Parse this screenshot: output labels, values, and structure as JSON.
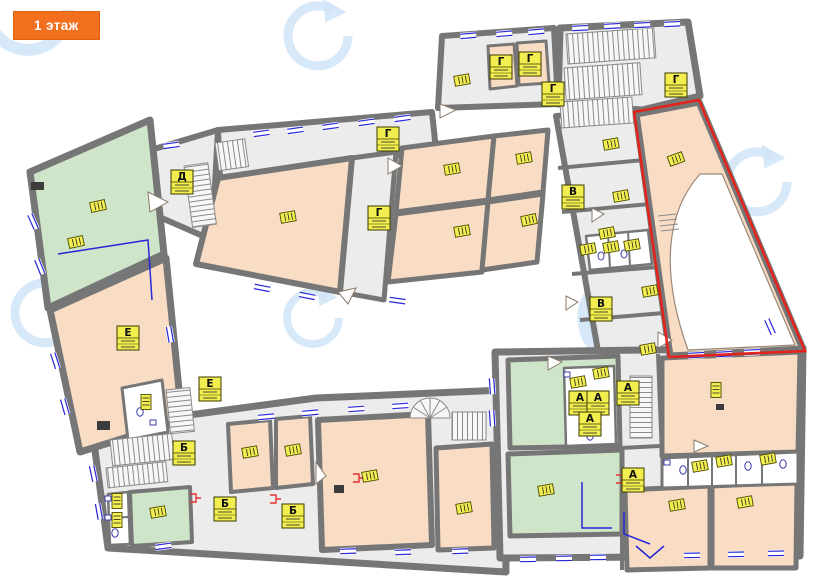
{
  "badge": {
    "label": "1 этаж"
  },
  "highlight": {
    "points": "634,112 699,100 805,351 669,357",
    "color": "#e3231c"
  },
  "colors": {
    "wall": "#767676",
    "floor_gray": "#ececec",
    "room_peach": "#f8dcc4",
    "room_green": "#cfe5c9",
    "label_bg": "#f2ee4f",
    "window_blue": "#2626d8",
    "watermark": "#d3e6f8",
    "highlight_red": "#e3231c"
  },
  "room_labels": [
    {
      "letter": "Г",
      "x": 501,
      "y": 67
    },
    {
      "letter": "Г",
      "x": 530,
      "y": 64
    },
    {
      "letter": "Г",
      "x": 553,
      "y": 94
    },
    {
      "letter": "Г",
      "x": 676,
      "y": 85
    },
    {
      "letter": "Г",
      "x": 388,
      "y": 139
    },
    {
      "letter": "Г",
      "x": 379,
      "y": 218
    },
    {
      "letter": "Д",
      "x": 182,
      "y": 182
    },
    {
      "letter": "В",
      "x": 573,
      "y": 197
    },
    {
      "letter": "В",
      "x": 601,
      "y": 309
    },
    {
      "letter": "Е",
      "x": 128,
      "y": 338
    },
    {
      "letter": "Е",
      "x": 210,
      "y": 389
    },
    {
      "letter": "Б",
      "x": 184,
      "y": 453
    },
    {
      "letter": "Б",
      "x": 225,
      "y": 509
    },
    {
      "letter": "Б",
      "x": 293,
      "y": 516
    },
    {
      "letter": "А",
      "x": 580,
      "y": 403
    },
    {
      "letter": "А",
      "x": 598,
      "y": 403
    },
    {
      "letter": "А",
      "x": 590,
      "y": 424
    },
    {
      "letter": "А",
      "x": 628,
      "y": 393
    },
    {
      "letter": "А",
      "x": 633,
      "y": 480
    }
  ],
  "mini_labels": [
    {
      "x": 98,
      "y": 206,
      "r": 78
    },
    {
      "x": 76,
      "y": 242,
      "r": 78
    },
    {
      "x": 288,
      "y": 217,
      "r": 80
    },
    {
      "x": 452,
      "y": 169,
      "r": 80
    },
    {
      "x": 524,
      "y": 158,
      "r": 80
    },
    {
      "x": 462,
      "y": 231,
      "r": 80
    },
    {
      "x": 529,
      "y": 220,
      "r": 78
    },
    {
      "x": 462,
      "y": 80,
      "r": 80
    },
    {
      "x": 611,
      "y": 144,
      "r": 80
    },
    {
      "x": 621,
      "y": 196,
      "r": 80
    },
    {
      "x": 607,
      "y": 233,
      "r": 80
    },
    {
      "x": 588,
      "y": 249,
      "r": 80
    },
    {
      "x": 611,
      "y": 247,
      "r": 80
    },
    {
      "x": 632,
      "y": 245,
      "r": 80
    },
    {
      "x": 650,
      "y": 291,
      "r": 80
    },
    {
      "x": 648,
      "y": 349,
      "r": 80
    },
    {
      "x": 676,
      "y": 159,
      "r": 70
    },
    {
      "x": 146,
      "y": 402,
      "r": 0
    },
    {
      "x": 117,
      "y": 501,
      "r": 0
    },
    {
      "x": 117,
      "y": 520,
      "r": 0
    },
    {
      "x": 158,
      "y": 512,
      "r": 80
    },
    {
      "x": 250,
      "y": 452,
      "r": 80
    },
    {
      "x": 293,
      "y": 450,
      "r": 80
    },
    {
      "x": 370,
      "y": 476,
      "r": 80
    },
    {
      "x": 464,
      "y": 508,
      "r": 80
    },
    {
      "x": 578,
      "y": 382,
      "r": 80
    },
    {
      "x": 601,
      "y": 373,
      "r": 80
    },
    {
      "x": 546,
      "y": 490,
      "r": 80
    },
    {
      "x": 716,
      "y": 390,
      "r": 0
    },
    {
      "x": 700,
      "y": 466,
      "r": 80
    },
    {
      "x": 724,
      "y": 461,
      "r": 80
    },
    {
      "x": 768,
      "y": 459,
      "r": 80
    },
    {
      "x": 677,
      "y": 505,
      "r": 80
    },
    {
      "x": 745,
      "y": 502,
      "r": 80
    }
  ],
  "windows": [
    {
      "x": 163,
      "y": 143,
      "a": -8
    },
    {
      "x": 253,
      "y": 131,
      "a": -8
    },
    {
      "x": 287,
      "y": 128,
      "a": -8
    },
    {
      "x": 322,
      "y": 124,
      "a": -8
    },
    {
      "x": 358,
      "y": 120,
      "a": -8
    },
    {
      "x": 394,
      "y": 116,
      "a": -8
    },
    {
      "x": 460,
      "y": 33,
      "a": -5
    },
    {
      "x": 496,
      "y": 31,
      "a": -5
    },
    {
      "x": 528,
      "y": 29,
      "a": -5
    },
    {
      "x": 572,
      "y": 25,
      "a": -3
    },
    {
      "x": 604,
      "y": 23,
      "a": -3
    },
    {
      "x": 634,
      "y": 22,
      "a": -3
    },
    {
      "x": 664,
      "y": 21,
      "a": -3
    },
    {
      "x": 770,
      "y": 318,
      "a": 66
    },
    {
      "x": 688,
      "y": 352,
      "a": -3
    },
    {
      "x": 716,
      "y": 351,
      "a": -3
    },
    {
      "x": 744,
      "y": 349,
      "a": -3
    },
    {
      "x": 520,
      "y": 556,
      "a": -1
    },
    {
      "x": 556,
      "y": 555,
      "a": -1
    },
    {
      "x": 590,
      "y": 554,
      "a": -1
    },
    {
      "x": 684,
      "y": 552,
      "a": -1
    },
    {
      "x": 728,
      "y": 551,
      "a": -1
    },
    {
      "x": 768,
      "y": 550,
      "a": -1
    },
    {
      "x": 155,
      "y": 544,
      "a": -8
    },
    {
      "x": 340,
      "y": 548,
      "a": -2
    },
    {
      "x": 395,
      "y": 549,
      "a": -2
    },
    {
      "x": 452,
      "y": 548,
      "a": -2
    },
    {
      "x": 33,
      "y": 213,
      "a": 66
    },
    {
      "x": 40,
      "y": 258,
      "a": 68
    },
    {
      "x": 56,
      "y": 352,
      "a": 72
    },
    {
      "x": 66,
      "y": 398,
      "a": 74
    },
    {
      "x": 95,
      "y": 465,
      "a": 78
    },
    {
      "x": 101,
      "y": 503,
      "a": 80
    },
    {
      "x": 255,
      "y": 283,
      "a": 11
    },
    {
      "x": 300,
      "y": 291,
      "a": 11
    },
    {
      "x": 390,
      "y": 296,
      "a": 8
    },
    {
      "x": 258,
      "y": 414,
      "a": -5
    },
    {
      "x": 302,
      "y": 410,
      "a": -5
    },
    {
      "x": 348,
      "y": 406,
      "a": -4
    },
    {
      "x": 392,
      "y": 403,
      "a": -4
    },
    {
      "x": 495,
      "y": 378,
      "a": 86
    },
    {
      "x": 495,
      "y": 410,
      "a": 86
    },
    {
      "x": 172,
      "y": 326,
      "a": 80
    }
  ],
  "watermarks": [
    {
      "x": 28,
      "y": 10,
      "r": 40
    },
    {
      "x": 318,
      "y": 36,
      "r": 30
    },
    {
      "x": 45,
      "y": 313,
      "r": 30
    },
    {
      "x": 313,
      "y": 318,
      "r": 26
    },
    {
      "x": 628,
      "y": 318,
      "r": 44
    },
    {
      "x": 757,
      "y": 182,
      "r": 30
    },
    {
      "x": 462,
      "y": 487,
      "r": 26
    },
    {
      "x": 752,
      "y": 480,
      "r": 30
    }
  ]
}
